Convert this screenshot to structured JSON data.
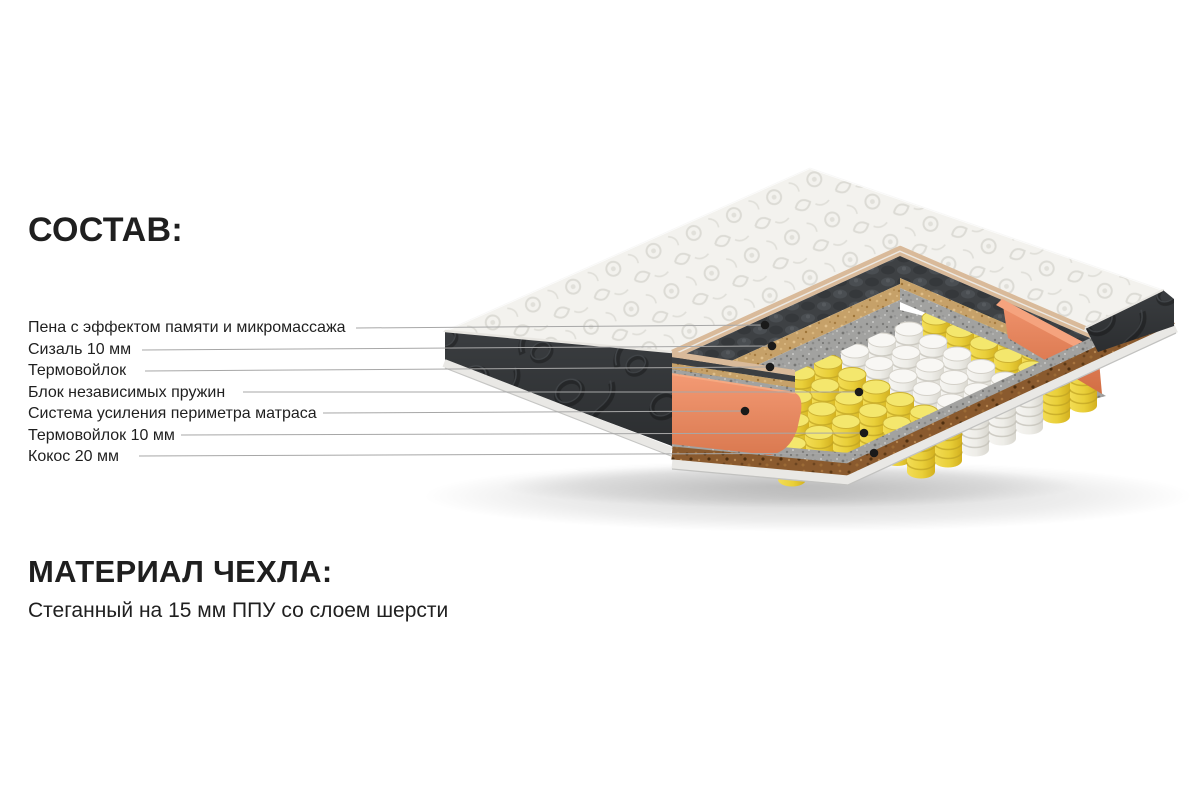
{
  "composition": {
    "title": "СОСТАВ:",
    "items": [
      {
        "label": "Пена с эффектом памяти и микромассажа",
        "target": "memory-foam-layer"
      },
      {
        "label": "Сизаль 10 мм",
        "target": "sisal-layer"
      },
      {
        "label": "Термовойлок",
        "target": "thermofelt-layer"
      },
      {
        "label": "Блок независимых пружин",
        "target": "independent-spring-block"
      },
      {
        "label": "Система усиления периметра матраса",
        "target": "perimeter-reinforcement"
      },
      {
        "label": "Термовойлок 10 мм",
        "target": "thermofelt-bottom-layer"
      },
      {
        "label": "Кокос 20 мм",
        "target": "coconut-layer"
      }
    ]
  },
  "cover": {
    "title": "МАТЕРИАЛ ЧЕХЛА:",
    "description": "Стеганный на 15 мм ППУ со слоем шерсти"
  },
  "illustration_palette": {
    "background": "#ffffff",
    "text": "#1f1f1f",
    "leader_line": "#a7a7a7",
    "callout_dot": "#1a1a1a",
    "cover_white": "#f3f2ee",
    "piping_tan": "#d9ba9a",
    "side_dark": "#3a3d40",
    "memory_foam_dark": "#3e4144",
    "sisal_tan": "#c6a169",
    "thermofelt_gray": "#a2a2a0",
    "springs_yellow": "#e9cf39",
    "springs_white": "#efeeea",
    "perimeter_orange": "#ea8a64",
    "coconut_brown": "#8a5a2e",
    "base_piping": "#e9e8e5"
  }
}
